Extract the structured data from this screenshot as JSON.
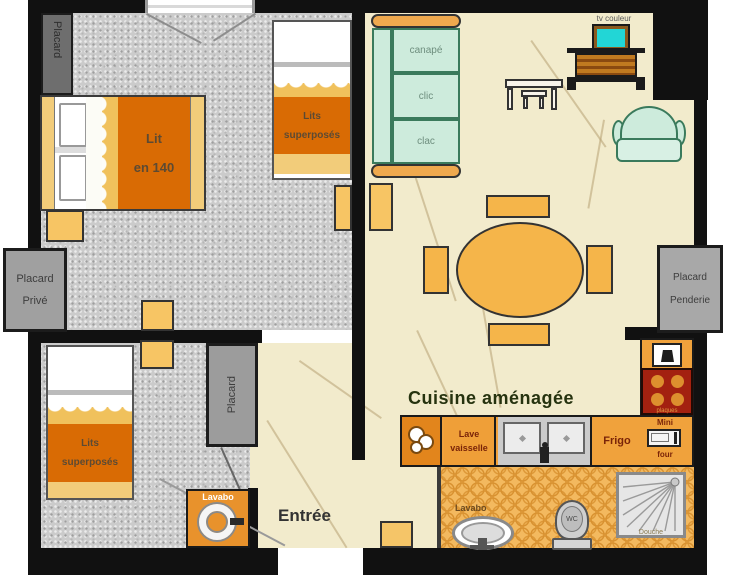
{
  "floorplan": {
    "bedroom1": {
      "closet_label": "Placard",
      "bed_line1": "Lit",
      "bed_line2": "en 140",
      "bunk_line1": "Lits",
      "bunk_line2": "superposés"
    },
    "bedroom2": {
      "closet_private_line1": "Placard",
      "closet_private_line2": "Privé",
      "closet_mid_label": "Placard",
      "bunk_line1": "Lits",
      "bunk_line2": "superposés",
      "sink_label": "Lavabo"
    },
    "living": {
      "tv_label": "tv couleur",
      "sofa_line1": "canapé",
      "sofa_line2": "clic",
      "sofa_line3": "clac",
      "closet_penderie_line1": "Placard",
      "closet_penderie_line2": "Penderie"
    },
    "hall": {
      "label": "Entrée"
    },
    "kitchen": {
      "title": "Cuisine aménagée",
      "dishwasher_line1": "Lave",
      "dishwasher_line2": "vaisselle",
      "fridge_label": "Frigo",
      "oven_line1": "Mini",
      "oven_line2": "four",
      "hob_label": "plaques"
    },
    "bathroom": {
      "sink_label": "Lavabo",
      "toilet_label": "WC",
      "shower_label": "Douche"
    }
  },
  "colors": {
    "wall": "#111111",
    "bedroom_floor": "#cbcbcb",
    "living_floor": "#f2ebcc",
    "bathroom_tile": "#f3b95f",
    "kitchen_counter": "#f0a23c",
    "furniture_orange": "#f5b54a",
    "blanket_orange": "#d96b04",
    "sofa_mint": "#cdebdc",
    "closet_gray": "#9c9c9c",
    "stove_red": "#a32110",
    "tv_screen": "#22d6d6"
  }
}
